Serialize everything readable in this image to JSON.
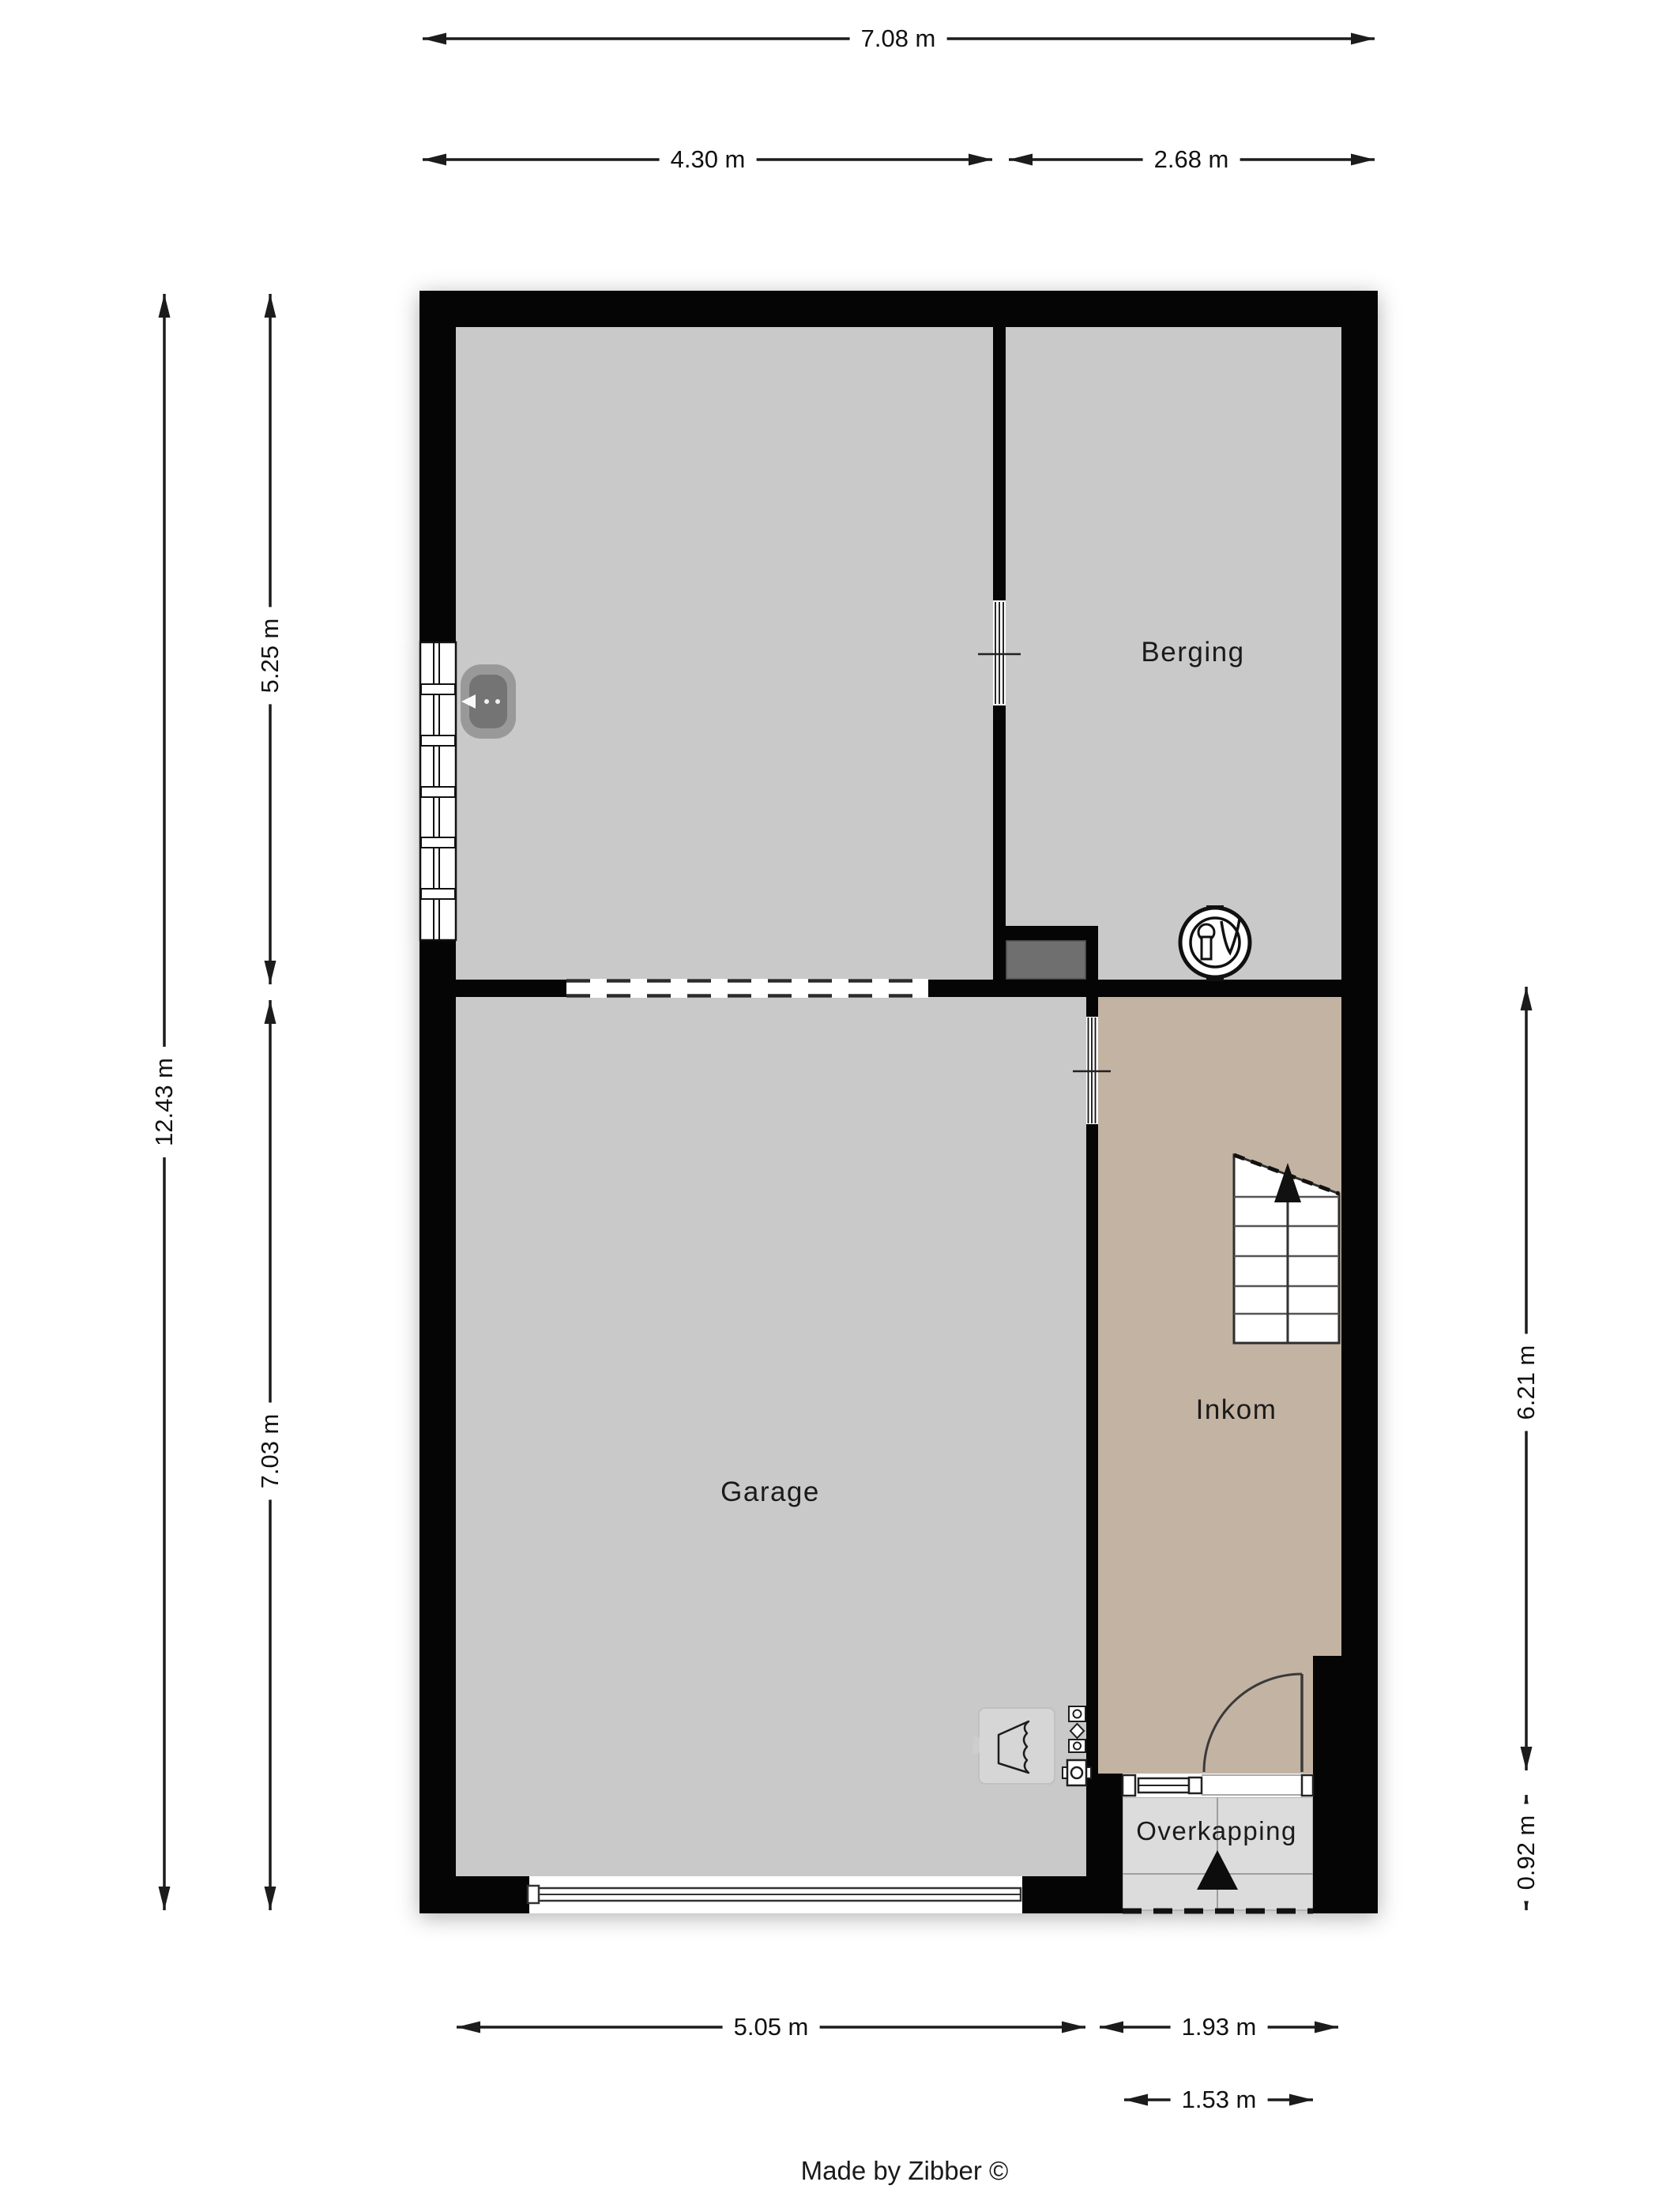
{
  "rooms": {
    "berging": "Berging",
    "garage": "Garage",
    "inkom": "Inkom",
    "overkapping": "Overkapping"
  },
  "dimensions": {
    "width_total": "7.08 m",
    "width_left": "4.30 m",
    "width_right": "2.68 m",
    "height_total": "12.43 m",
    "height_upper": "5.25 m",
    "height_lower": "7.03 m",
    "inkom_height": "6.21 m",
    "overkapping_depth": "0.92 m",
    "garage_width": "5.05 m",
    "inkom_width": "1.93 m",
    "overkapping_width": "1.53 m"
  },
  "footer": {
    "credit": "Made by Zibber ©"
  },
  "icons": {
    "boiler": "boiler-icon",
    "stair_arrow": "arrow-up-icon",
    "entrance_arrow": "triangle-up-icon",
    "radiator": "radiator-icon",
    "basin": "basin-icon"
  },
  "colors": {
    "wall": "#050505",
    "room_gray": "#c9c9c9",
    "inkom_tan": "#c3b3a2",
    "overkapping_gray": "#dcdcdc",
    "step_gray": "#6f6f6f",
    "dim_line": "#1c1c1c"
  }
}
